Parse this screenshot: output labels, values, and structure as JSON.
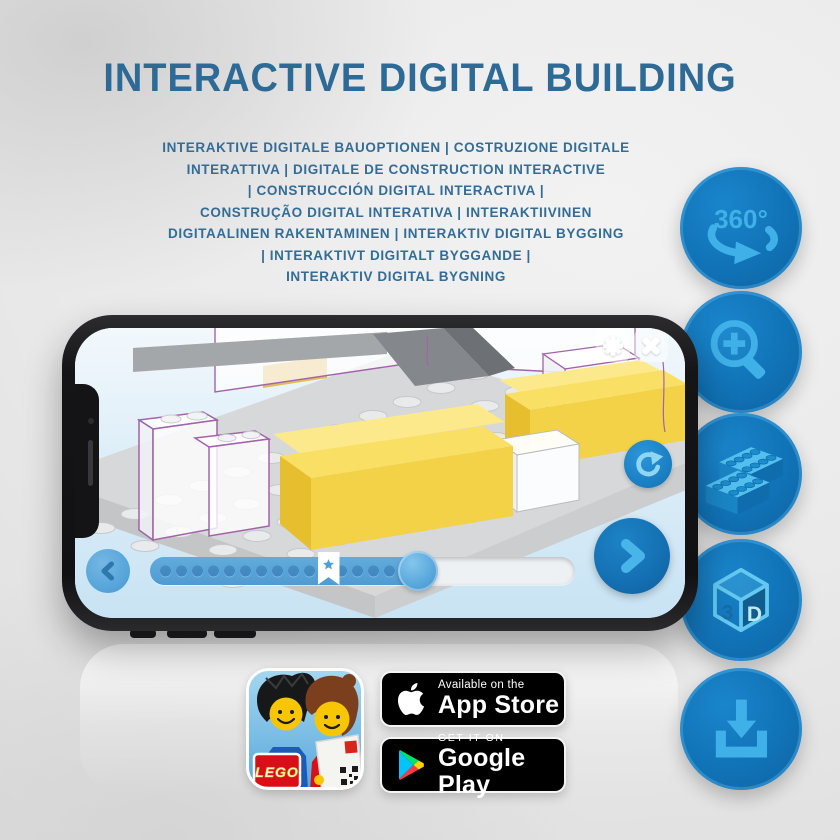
{
  "header": {
    "title": "INTERACTIVE DIGITAL BUILDING",
    "subtitle": "INTERAKTIVE DIGITALE BAUOPTIONEN | COSTRUZIONE DIGITALE\nINTERATTIVA | DIGITALE DE CONSTRUCTION INTERACTIVE\n| CONSTRUCCIÓN DIGITAL INTERACTIVA |\nCONSTRUÇÃO DIGITAL INTERATIVA | INTERAKTIIVINEN\nDIGITAALINEN RAKENTAMINEN | INTERAKTIV DIGITAL BYGGING\n| INTERAKTIVT DIGITALT BYGGANDE |\nINTERAKTIV DIGITAL BYGNING"
  },
  "features": {
    "rotate360": {
      "label": "360°",
      "icon": "rotation-360-icon"
    },
    "zoom": {
      "icon": "zoom-in-icon"
    },
    "brick": {
      "icon": "brick-icon"
    },
    "threeD": {
      "left": "3",
      "right": "D",
      "icon": "cube-3d-icon"
    },
    "download": {
      "icon": "download-icon"
    }
  },
  "phone": {
    "builder_ui": {
      "progress_percent": 63,
      "bookmark_percent": 42,
      "dot_count": 17,
      "icons": [
        "settings-gear-icon",
        "close-icon",
        "rotate-reset-icon",
        "prev-chevron-icon",
        "next-chevron-icon",
        "bookmark-star-icon"
      ]
    }
  },
  "badges": {
    "app_store": {
      "tagline": "Available on the",
      "store": "App Store",
      "icon": "apple-icon"
    },
    "google_play": {
      "tagline": "GET IT ON",
      "store": "Google Play",
      "icon": "google-play-icon"
    }
  },
  "app_icon": {
    "brand": "LEGO",
    "icon": "lego-app-icon"
  },
  "colors": {
    "title_blue": "#2e6a96",
    "circle_blue": "#1173b7",
    "icon_light_blue": "#3fb0e8",
    "screen_sky": "#d9ecf8",
    "highlight_yellow": "#f7da52",
    "outline_purple": "#a263aa",
    "badge_black": "#000000"
  }
}
